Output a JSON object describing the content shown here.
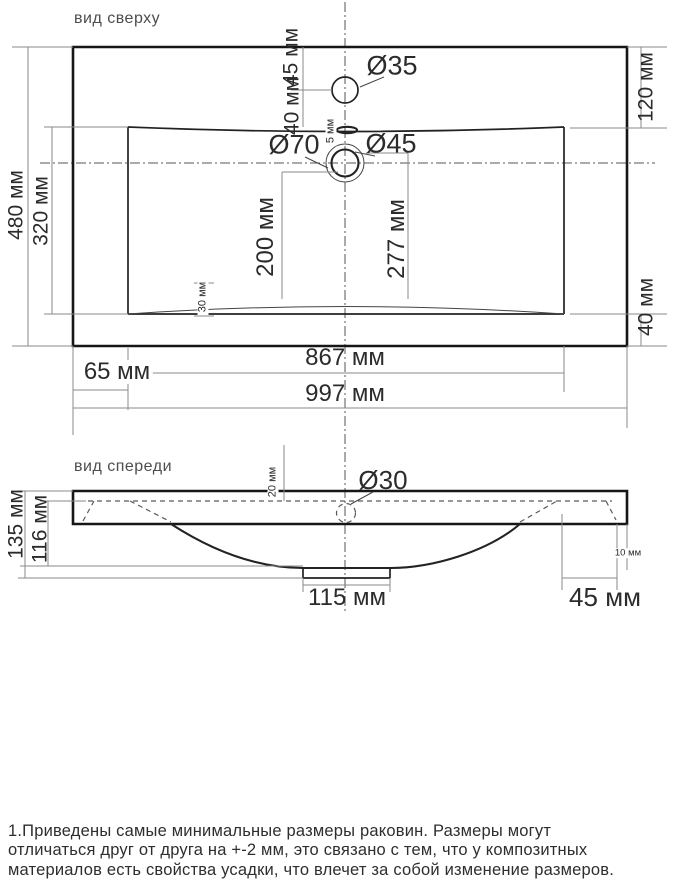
{
  "top_view": {
    "title": "вид сверху",
    "dims": {
      "d45_top": "45 мм",
      "d40_top": "40 мм",
      "faucet_hole": "Ø35",
      "d5": "5 мм",
      "drain_outer": "Ø70",
      "drain_inner": "Ø45",
      "d480": "480 мм",
      "d320": "320 мм",
      "d200": "200 мм",
      "d277": "277 мм",
      "d30": "30 мм",
      "d120": "120 мм",
      "d40_right": "40 мм",
      "d867": "867 мм",
      "d65": "65 мм",
      "d997": "997 мм"
    }
  },
  "front_view": {
    "title": "вид спереди",
    "dims": {
      "d20": "20 мм",
      "overflow_hole": "Ø30",
      "d135": "135 мм",
      "d116": "116 мм",
      "d10": "10 мм",
      "d115": "115 мм",
      "d45": "45 мм"
    }
  },
  "notes": {
    "lines": [
      "1.Приведены самые минимальные размеры раковин. Размеры могут",
      "отличаться друг от друга на +-2 мм, это связано с тем, что у композитных",
      "материалов есть свойства усадки, что влечет за собой изменение размеров."
    ]
  },
  "colors": {
    "line": "#161616",
    "thin_line": "#8a8a8a",
    "text": "#2b2b2b"
  }
}
